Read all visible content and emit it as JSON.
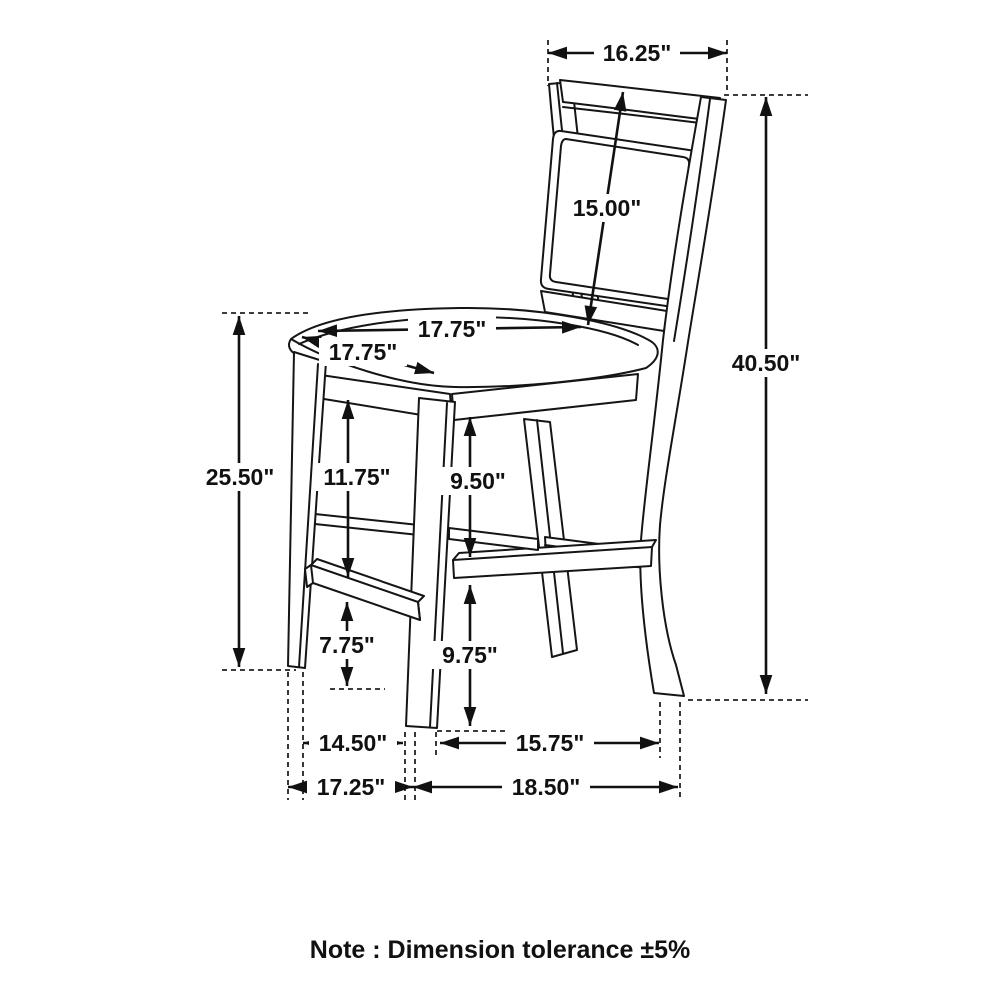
{
  "diagram": {
    "subject": "counter-height chair line drawing with dimensions",
    "line_color": "#151515",
    "background": "#ffffff"
  },
  "dims": {
    "back_width": "16.25\"",
    "back_height": "15.00\"",
    "overall_height": "40.50\"",
    "seat_width": "17.75\"",
    "seat_depth": "17.75\"",
    "seat_height": "25.50\"",
    "seat_to_front_stretcher": "11.75\"",
    "seat_to_side_stretcher": "9.50\"",
    "front_stretcher_to_floor": "7.75\"",
    "side_stretcher_to_floor": "9.75\"",
    "front_legs_inner_width": "14.50\"",
    "front_to_back_leg_depth": "15.75\"",
    "base_width": "17.25\"",
    "base_depth": "18.50\""
  },
  "note": "Note : Dimension tolerance ±5%"
}
